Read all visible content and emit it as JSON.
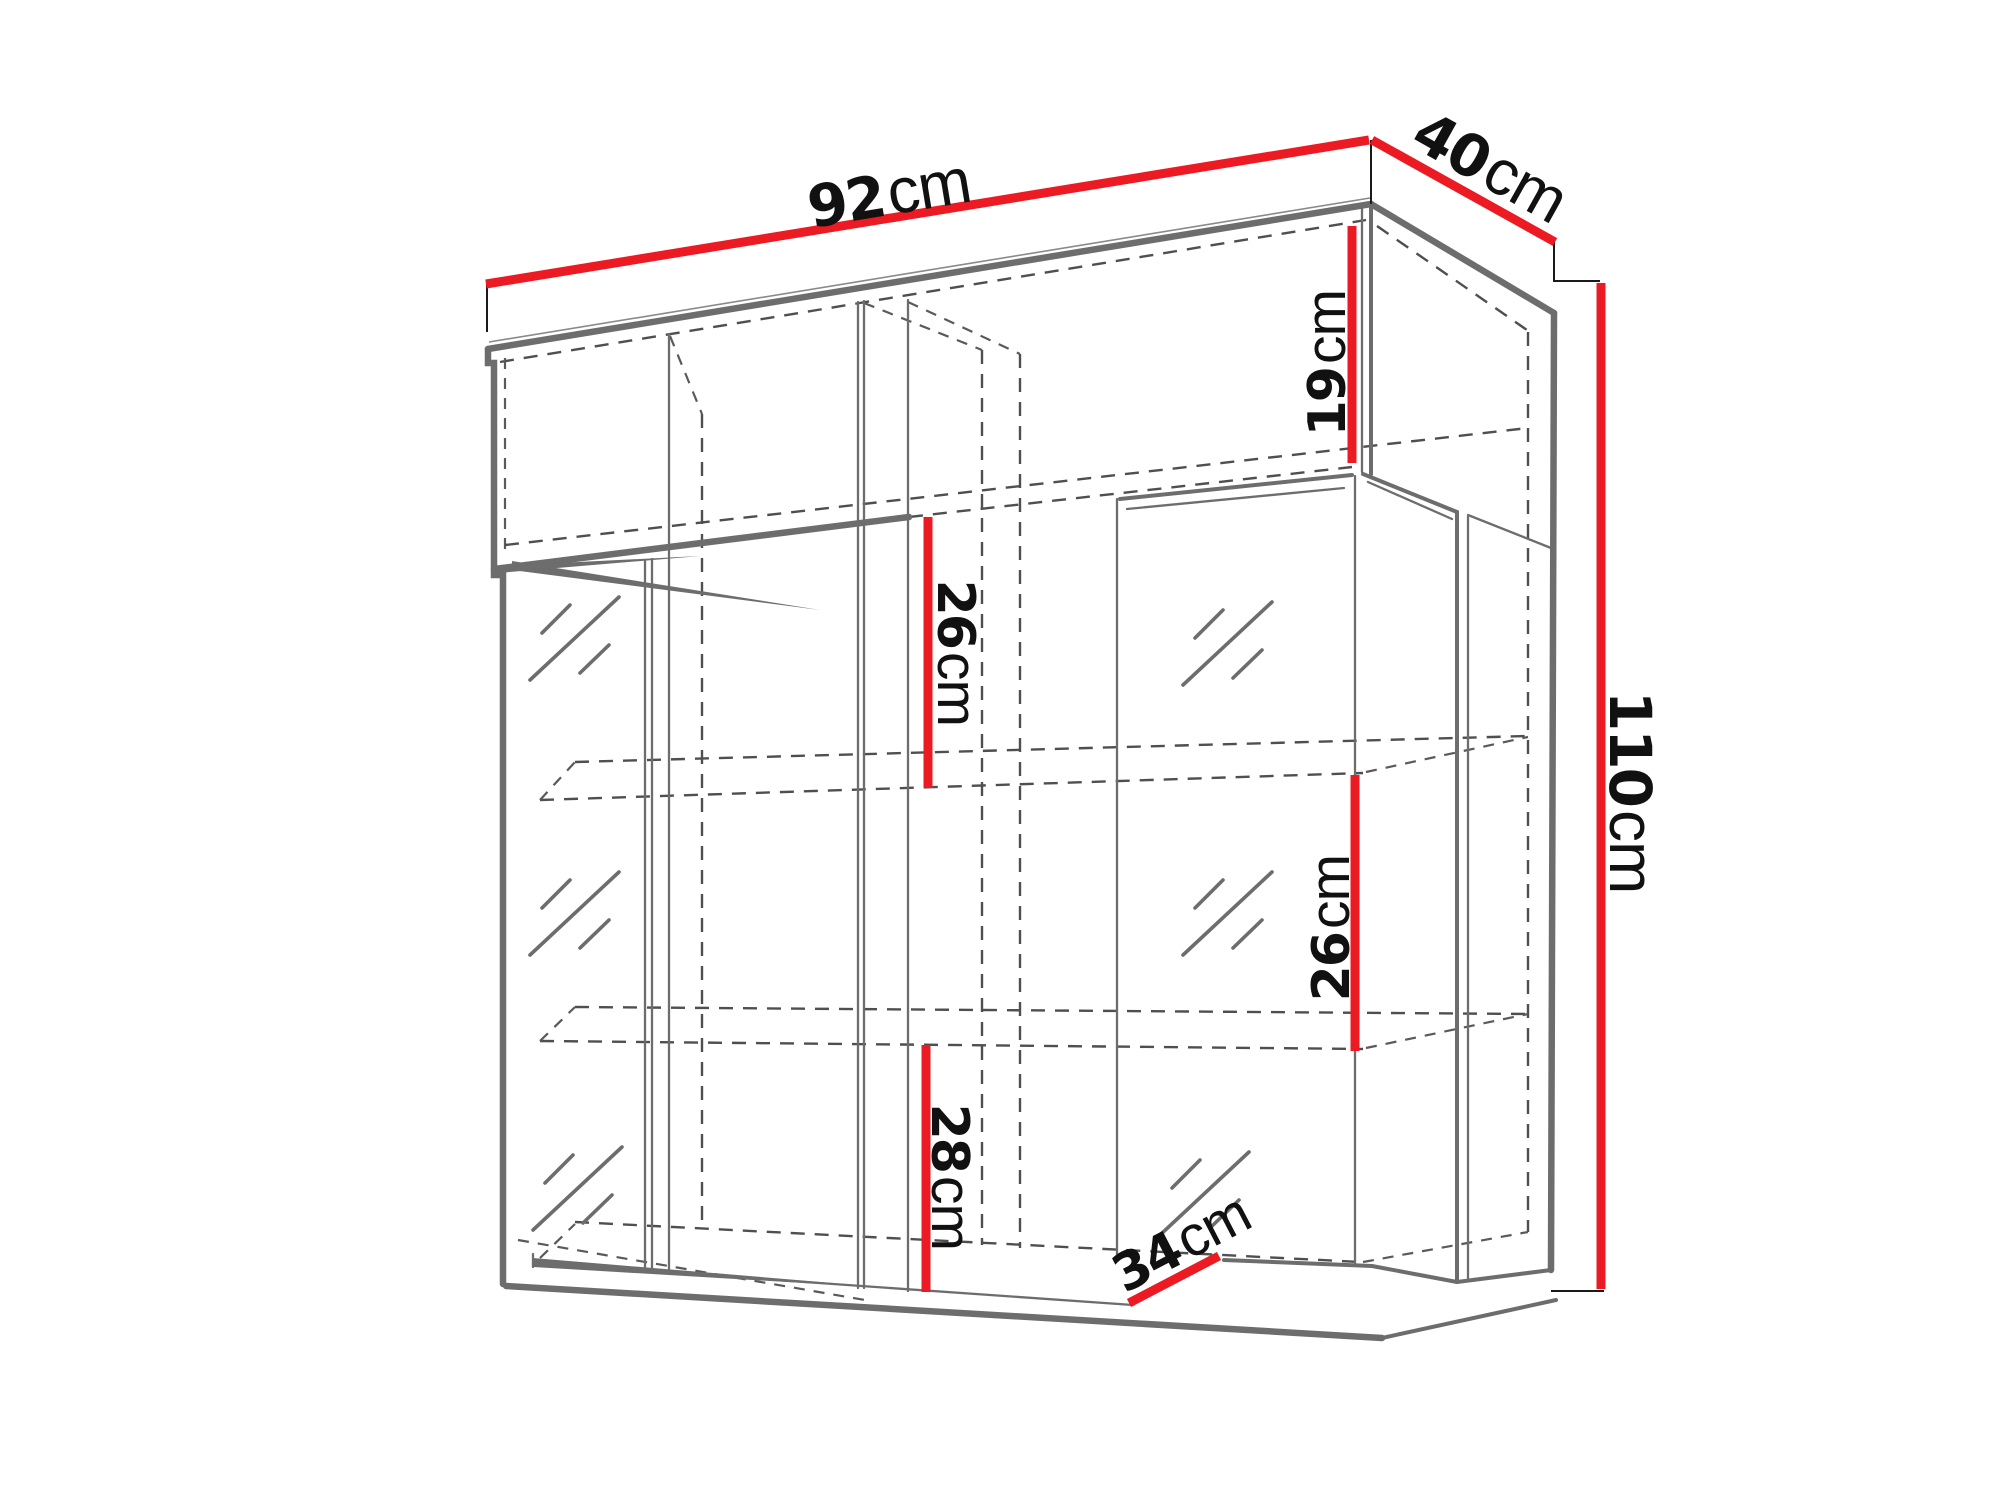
{
  "diagram": {
    "type": "furniture-dimension-drawing",
    "unit_default": "cm",
    "dimensions": {
      "width": {
        "value": "92",
        "unit": "cm"
      },
      "depth": {
        "value": "40",
        "unit": "cm"
      },
      "height": {
        "value": "110",
        "unit": "cm"
      },
      "top_compartment_height": {
        "value": "19",
        "unit": "cm"
      },
      "middle_compartment_height": {
        "value": "26",
        "unit": "cm"
      },
      "right_compartment_height": {
        "value": "26",
        "unit": "cm"
      },
      "bottom_compartment_height": {
        "value": "28",
        "unit": "cm"
      },
      "bottom_compartment_depth": {
        "value": "34",
        "unit": "cm"
      }
    },
    "colors": {
      "dimension_line": "#ec1b23",
      "outline": "#6d6d6d",
      "hidden_line": "#4f4f4f",
      "label_text": "#111111",
      "background": "#ffffff"
    }
  }
}
